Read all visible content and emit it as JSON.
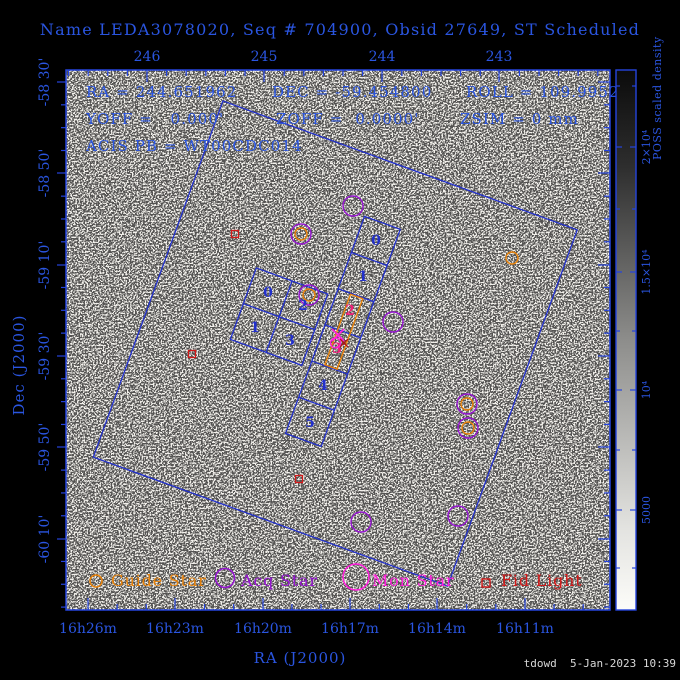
{
  "window": {
    "title_line": "Name LEDA3078020, Seq # 704900, Obsid 27649, ST Scheduled",
    "timestamp": "tdowd  5-Jan-2023 10:39"
  },
  "info": {
    "line1_ra": "RA = 244.651962",
    "line1_dec": "DEC = -59.454800",
    "line1_roll": "ROLL = 109.9952",
    "line2_yoff": "YOFF =   0.000'",
    "line2_zoff": "ZOFF =  0.0000'",
    "line2_zsim": "ZSIM = 0 mm",
    "line3_acis": "ACIS PB = WT00CDC014"
  },
  "axes": {
    "x_top": {
      "ticks": [
        {
          "label": "246",
          "x": 147
        },
        {
          "label": "245",
          "x": 264
        },
        {
          "label": "244",
          "x": 382
        },
        {
          "label": "243",
          "x": 499
        }
      ],
      "minor_step": 19.6
    },
    "x_bottom": {
      "label": "RA (J2000)",
      "ticks": [
        {
          "label": "16h26m",
          "x": 88
        },
        {
          "label": "16h23m",
          "x": 175
        },
        {
          "label": "16h20m",
          "x": 263
        },
        {
          "label": "16h17m",
          "x": 350
        },
        {
          "label": "16h14m",
          "x": 437
        },
        {
          "label": "16h11m",
          "x": 525
        }
      ],
      "minor_step": 29.13
    },
    "y_left": {
      "label": "Dec (J2000)",
      "ticks": [
        {
          "label": "-58 30'",
          "y": 82
        },
        {
          "label": "-58 50'",
          "y": 173
        },
        {
          "label": "-59 10'",
          "y": 265
        },
        {
          "label": "-59 30'",
          "y": 356
        },
        {
          "label": "-59 50'",
          "y": 447
        },
        {
          "label": "-60 10'",
          "y": 539
        }
      ],
      "minor_step": 22.83
    }
  },
  "colorbar": {
    "title": "POSS scaled density",
    "ticks": [
      {
        "label": "2×10⁴",
        "y": 147
      },
      {
        "label": "1.5×10⁴",
        "y": 272
      },
      {
        "label": "10⁴",
        "y": 390
      },
      {
        "label": "5000",
        "y": 510
      }
    ],
    "minor_y": [
      86,
      209,
      331,
      450,
      568
    ]
  },
  "detector": {
    "rotation_deg": 20,
    "pivot": {
      "x": 338,
      "y": 336
    },
    "acis_i_labels": [
      {
        "text": "0",
        "x": 268,
        "y": 293
      },
      {
        "text": "2",
        "x": 303,
        "y": 306
      },
      {
        "text": "1",
        "x": 255,
        "y": 328
      },
      {
        "text": "3",
        "x": 290,
        "y": 341
      }
    ],
    "acis_s_labels": [
      {
        "text": "0",
        "x": 376,
        "y": 241,
        "hl": false
      },
      {
        "text": "1",
        "x": 363,
        "y": 277,
        "hl": false
      },
      {
        "text": "2",
        "x": 350,
        "y": 311,
        "hl": true
      },
      {
        "text": "3",
        "x": 337,
        "y": 349,
        "hl": true
      },
      {
        "text": "4",
        "x": 323,
        "y": 386,
        "hl": false
      },
      {
        "text": "5",
        "x": 310,
        "y": 423,
        "hl": false
      }
    ]
  },
  "stars": [
    {
      "type": "acq",
      "x": 353,
      "y": 206
    },
    {
      "type": "guide_acq",
      "x": 301,
      "y": 234
    },
    {
      "type": "fid",
      "x": 235,
      "y": 234
    },
    {
      "type": "guide_acq",
      "x": 309,
      "y": 295
    },
    {
      "type": "guide",
      "x": 512,
      "y": 258
    },
    {
      "type": "acq",
      "x": 393,
      "y": 322
    },
    {
      "type": "fid",
      "x": 192,
      "y": 354
    },
    {
      "type": "guide_acq",
      "x": 467,
      "y": 404
    },
    {
      "type": "guide_acq",
      "x": 468,
      "y": 428
    },
    {
      "type": "fid",
      "x": 299,
      "y": 479
    },
    {
      "type": "acq",
      "x": 361,
      "y": 522
    },
    {
      "type": "acq",
      "x": 458,
      "y": 516
    }
  ],
  "aimpoint": {
    "x": 338,
    "y": 335
  },
  "legend": [
    {
      "label": "Guide Star",
      "kind": "circle",
      "r": 6,
      "sx": 96,
      "sy": 581,
      "tx": 111,
      "color": "#e8820a"
    },
    {
      "label": "Acq Star",
      "kind": "circle",
      "r": 9.5,
      "sx": 225,
      "sy": 578,
      "tx": 241,
      "color": "#9614d2"
    },
    {
      "label": "Mon Star",
      "kind": "circle",
      "r": 13,
      "sx": 356,
      "sy": 577,
      "tx": 372,
      "color": "#ff1edc"
    },
    {
      "label": "Fid Light",
      "kind": "square",
      "r": 4,
      "sx": 486,
      "sy": 583,
      "tx": 501,
      "color": "#d21919"
    }
  ],
  "colors": {
    "text_blue": "#2a55e0",
    "line_blue": "#2230cc",
    "frame_blue": "#2544dd",
    "orange": "#e8820a",
    "purple": "#9614d2",
    "magenta": "#ff1edc",
    "pink": "#f01e78",
    "red": "#d21919",
    "plot_bg": "#f3f1ec",
    "timestamp": "#d8d8d8"
  }
}
